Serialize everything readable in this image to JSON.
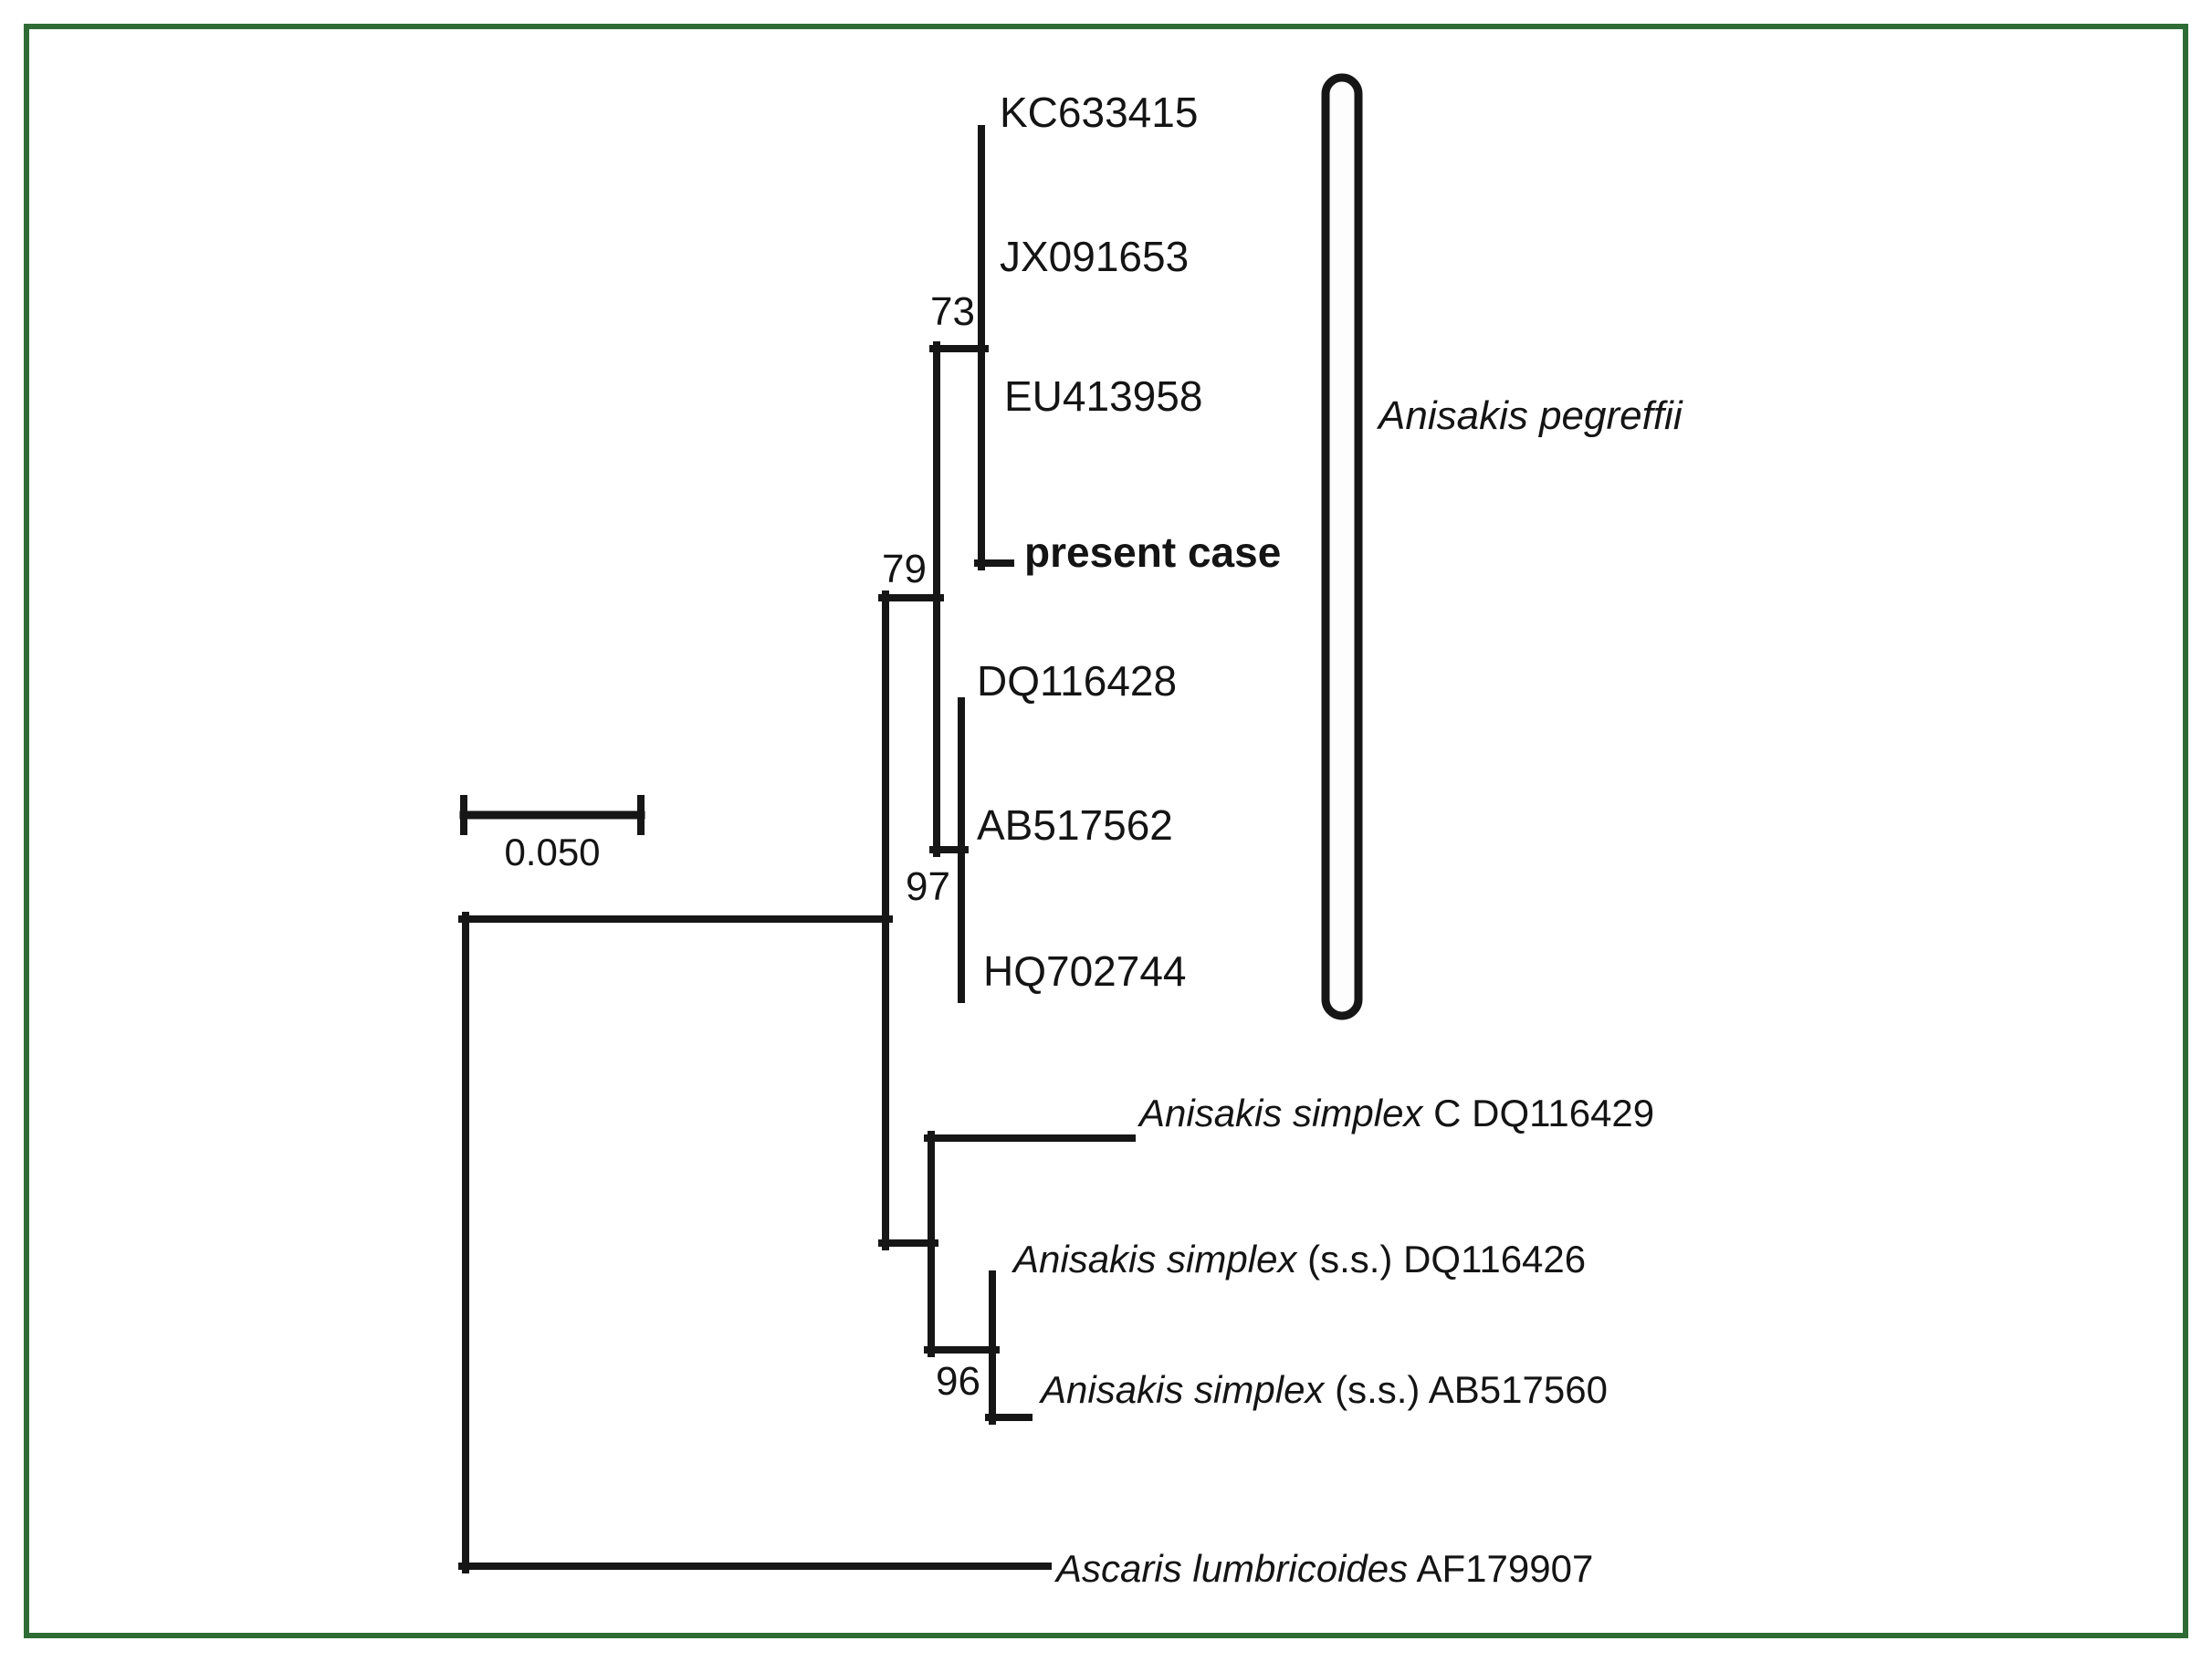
{
  "colors": {
    "background": "#ffffff",
    "figure_border_green": "#2e6b35",
    "tree_line_black": "#161616"
  },
  "scale_bar": {
    "label": "0.050"
  },
  "clade_bracket": {
    "label_italic": "Anisakis pegreffii"
  },
  "bootstrap": {
    "n73": "73",
    "n79": "79",
    "n97": "97",
    "n96": "96"
  },
  "tips": {
    "kc": "KC633415",
    "jx": "JX091653",
    "eu": "EU413958",
    "present": "present case",
    "dq8": "DQ116428",
    "ab2": "AB517562",
    "hq": "HQ702744",
    "simplex_c": {
      "italic": "Anisakis simplex",
      "regular": " C DQ116429"
    },
    "simplex_dq": {
      "italic": "Anisakis simplex",
      "regular": " (s.s.) DQ116426"
    },
    "simplex_ab": {
      "italic": "Anisakis simplex",
      "regular": " (s.s.) AB517560"
    },
    "ascaris": {
      "italic": "Ascaris lumbricoides",
      "regular": " AF179907"
    }
  },
  "phylogeny": {
    "type": "phylogenetic_tree",
    "newick": "((((KC633415,JX091653,EU413958,present case)73,(DQ116428,AB517562,HQ702744)97)79,(Anisakis simplex C DQ116429,(Anisakis simplex (s.s.) DQ116426,Anisakis simplex (s.s.) AB517560)96)),Ascaris lumbricoides AF179907)",
    "clade_annotation": "Anisakis pegreffii bracket spans KC633415, JX091653, EU413958, present case, DQ116428, AB517562, HQ702744",
    "scale_value": "0.050"
  }
}
